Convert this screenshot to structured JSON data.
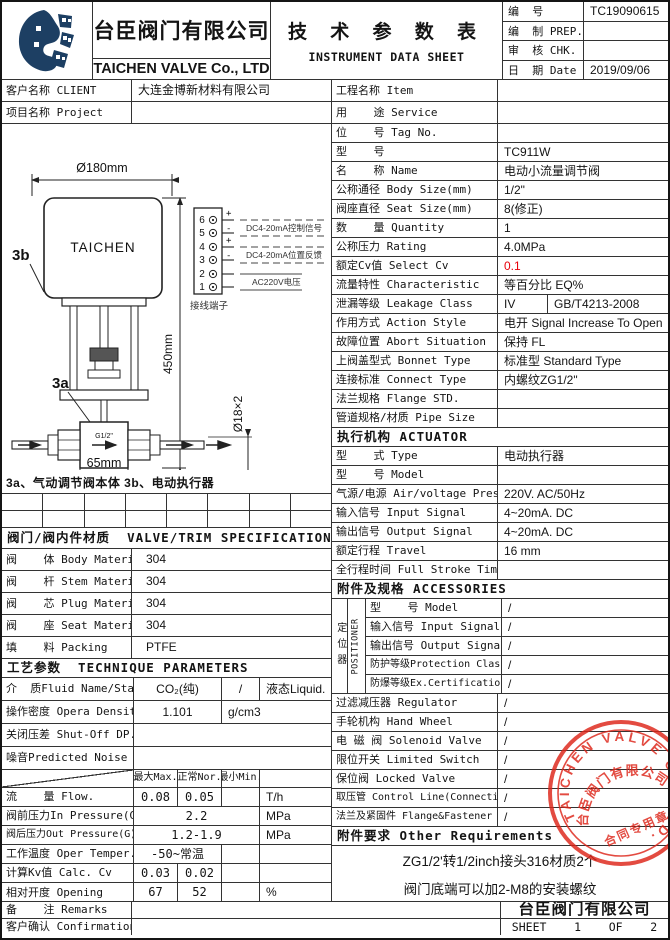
{
  "header": {
    "company_zh": "台臣阀门有限公司",
    "company_en": "TAICHEN VALVE Co., LTD",
    "title_zh": "技 术 参 数 表",
    "title_en": "INSTRUMENT DATA SHEET",
    "doc_no_label": "编  号",
    "doc_no": "TC19090615",
    "prep_label": "编  制 PREP.",
    "prep": "",
    "chk_label": "审  核 CHK.",
    "chk": "",
    "date_label": "日  期 Date",
    "date": "2019/09/06"
  },
  "client": {
    "label": "客户名称 CLIENT",
    "value": "大连金博新材料有限公司"
  },
  "project": {
    "label": "项目名称 Project",
    "value": ""
  },
  "item": {
    "label": "工程名称 Item",
    "value": ""
  },
  "service": {
    "label": "用    途 Service",
    "value": ""
  },
  "drawing": {
    "dim_top": "Ø180mm",
    "dim_height": "450mm",
    "dim_pipe": "Ø18×2",
    "dim_width": "65mm",
    "port": "G1/2\"",
    "brand": "TAICHEN",
    "label_3a": "3a",
    "label_3b": "3b",
    "terminal_caption": "接线端子",
    "t6": "6",
    "t5": "5",
    "t4": "4",
    "t3": "3",
    "t2": "2",
    "t1": "1",
    "wire1": "DC4-20mA控制信号",
    "wire2": "DC4-20mA位置反馈",
    "wire3": "AC220V电压",
    "caption": "3a、气动调节阀本体 3b、电动执行器"
  },
  "specs": [
    {
      "label": "位    号 Tag No.",
      "value": ""
    },
    {
      "label": "型    号",
      "value": "TC911W"
    },
    {
      "label": "名    称 Name",
      "value": "电动小流量调节阀"
    },
    {
      "label": "公称通径 Body Size(mm)",
      "value": "1/2\""
    },
    {
      "label": "阀座直径 Seat Size(mm)",
      "value": "8(修正)"
    },
    {
      "label": "数    量 Quantity",
      "value": "1"
    },
    {
      "label": "公称压力 Rating",
      "value": "4.0MPa"
    },
    {
      "label": "额定Cv值 Select Cv",
      "value": "0.1"
    },
    {
      "label": "流量特性 Characteristic",
      "value": "等百分比 EQ%"
    },
    {
      "label": "泄漏等级 Leakage Class",
      "value": "IV",
      "value2": "GB/T4213-2008"
    },
    {
      "label": "作用方式 Action Style",
      "value": "电开 Signal Increase To Open"
    },
    {
      "label": "故障位置 Abort Situation",
      "value": "保持 FL"
    },
    {
      "label": "上阀盖型式 Bonnet Type",
      "value": "标准型 Standard Type"
    },
    {
      "label": "连接标准 Connect Type",
      "value": "内螺纹ZG1/2\""
    },
    {
      "label": "法兰规格 Flange STD.",
      "value": ""
    },
    {
      "label": "管道规格/材质 Pipe Size",
      "value": ""
    }
  ],
  "actuator": {
    "header": "执行机构 ACTUATOR",
    "rows": [
      {
        "label": "型    式 Type",
        "value": "电动执行器"
      },
      {
        "label": "型    号 Model",
        "value": ""
      },
      {
        "label": "气源/电源 Air/voltage Press",
        "value": "220V. AC/50Hz"
      },
      {
        "label": "输入信号 Input Signal",
        "value": "4~20mA. DC"
      },
      {
        "label": "输出信号 Output Signal",
        "value": "4~20mA. DC"
      },
      {
        "label": "额定行程 Travel",
        "value": "16 mm"
      },
      {
        "label": "全行程时间 Full Stroke Time",
        "value": ""
      }
    ]
  },
  "accessories": {
    "header": "附件及规格 ACCESSORIES",
    "positioner_zh": "定位器",
    "positioner_en": "POSITIONER",
    "positioner_rows": [
      {
        "label": "型    号 Model",
        "value": "/"
      },
      {
        "label": "输入信号 Input Signal",
        "value": "/"
      },
      {
        "label": "输出信号 Output Signal",
        "value": "/"
      },
      {
        "label": "防护等级Protection Class",
        "value": "/"
      },
      {
        "label": "防爆等级Ex.Certification",
        "value": "/"
      }
    ],
    "rows": [
      {
        "label": "过滤减压器 Regulator",
        "value": "/"
      },
      {
        "label": "手轮机构 Hand Wheel",
        "value": "/"
      },
      {
        "label": "电 磁 阀 Solenoid Valve",
        "value": "/"
      },
      {
        "label": "限位开关 Limited Switch",
        "value": "/"
      },
      {
        "label": "保位阀 Locked Valve",
        "value": "/"
      },
      {
        "label": "取压管 Control Line(Connection.)",
        "value": "/"
      },
      {
        "label": "法兰及紧固件 Flange&Fastener",
        "value": "/"
      }
    ],
    "other_header": "附件要求 Other Requirements",
    "other_line1": "ZG1/2'转1/2inch接头316材质2个",
    "other_line2": "阀门底端可以加2-M8的安装螺纹"
  },
  "trim": {
    "header": "阀门/阀内件材质  VALVE/TRIM SPECIFICATION",
    "rows": [
      {
        "label": "阀    体 Body Material",
        "value": "304"
      },
      {
        "label": "阀    杆 Stem Material",
        "value": "304"
      },
      {
        "label": "阀    芯 Plug Material",
        "value": "304"
      },
      {
        "label": "阀    座 Seat Material",
        "value": "304"
      },
      {
        "label": "填    料 Packing",
        "value": "PTFE"
      }
    ]
  },
  "technique": {
    "header": "工艺参数  TECHNIQUE PARAMETERS",
    "fluid": {
      "label": "介  质Fluid Name/State",
      "v1": "CO₂(纯)",
      "v2": "/",
      "v3": "液态Liquid."
    },
    "density": {
      "label": "操作密度 Opera Density",
      "v1": "1.101",
      "v2": "g/cm3"
    },
    "shutoff": {
      "label": "关闭压差 Shut-Off DP.",
      "value": ""
    },
    "noise": {
      "label": "噪音Predicted Noise",
      "value": ""
    },
    "col_max": "最大Max.",
    "col_nor": "正常Nor.",
    "col_min": "最小Min.",
    "flow": {
      "label": "流    量 Flow.",
      "max": "0.08",
      "nor": "0.05",
      "min": "",
      "unit": "T/h"
    },
    "inpress": {
      "label": "阀前压力In Pressure(G)",
      "value": "2.2",
      "unit": "MPa"
    },
    "outpress": {
      "label": "阀后压力Out Pressure(G)",
      "value": "1.2-1.9",
      "unit": "MPa"
    },
    "temper": {
      "label": "工作温度 Oper Temper.",
      "value": "-50~常温",
      "unit": ""
    },
    "kv": {
      "label": "计算Kv值 Calc. Cv",
      "max": "0.03",
      "nor": "0.02",
      "min": "",
      "unit": ""
    },
    "opening": {
      "label": "相对开度 Opening",
      "max": "67",
      "nor": "52",
      "min": "",
      "unit": "%"
    }
  },
  "footer": {
    "remarks_label": "备    注 Remarks",
    "remarks": "",
    "confirm_label": "客户确认 Confirmation",
    "confirm": "",
    "company": "台臣阀门有限公司",
    "sheet": "SHEET    1    OF    2"
  },
  "stamp": {
    "ring_text": "TAICHEN VALVE CO.,LTD.",
    "company": "台臣阀门有限公司",
    "caption": "合同专用章",
    "color": "#dd2418"
  },
  "colors": {
    "highlight": "#e8000a",
    "navy": "#1d3f63",
    "stamp": "#dd2418"
  }
}
